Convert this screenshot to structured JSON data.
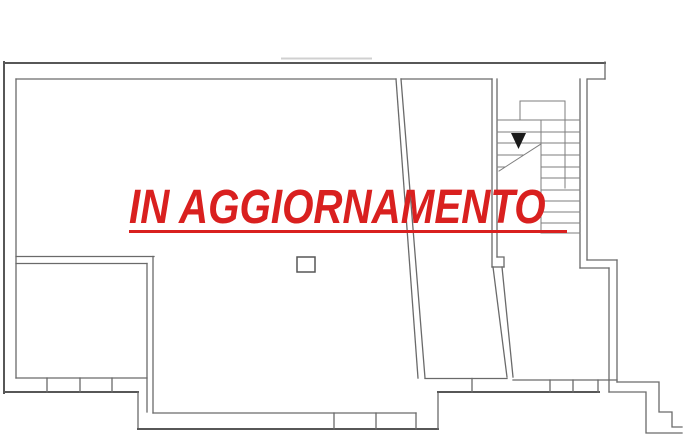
{
  "watermark": {
    "text": "IN AGGIORNAMENTO"
  },
  "colors": {
    "accent_red": "#d9201f",
    "wall_dark": "#575757",
    "wall_mid": "#6a6a6a",
    "stair_gray": "#7e7e7e",
    "arrow_black": "#1a1a1a",
    "background": "#ffffff"
  },
  "icons": {
    "stair_direction_arrow": "triangle-down"
  }
}
